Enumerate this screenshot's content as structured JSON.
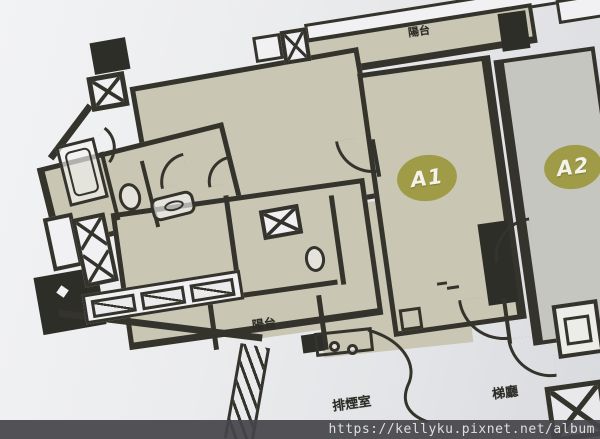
{
  "colors": {
    "wall": "#34332c",
    "unit_fill": "#c9c6b3",
    "a2_fill": "#c6c6c1",
    "badge": "#a09b47",
    "black_block": "#2e2e29",
    "white_fill": "#f1f1f3",
    "watermark_text": "#dfdfe1"
  },
  "plan": {
    "balcony_top_label": "陽台",
    "balcony_inner_label": "陽台",
    "unit_a1_label": "A1",
    "unit_a2_label": "A2",
    "smoke_room_label": "排煙室",
    "lift_lobby_label": "梯廳"
  },
  "watermark": {
    "url_text": "https://kellyku.pixnet.net/album"
  }
}
